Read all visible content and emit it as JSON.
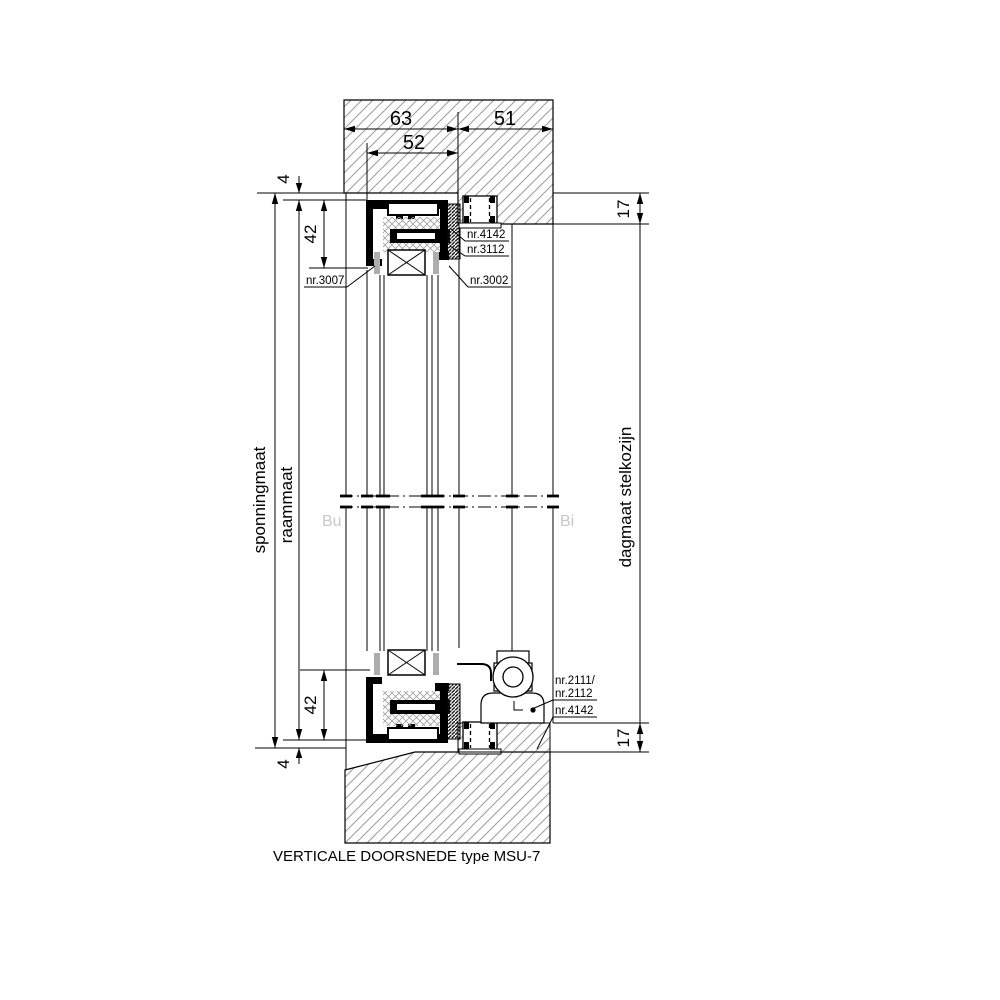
{
  "drawing": {
    "caption": "VERTICALE DOORSNEDE type  MSU-7",
    "section_markers": {
      "outside": "Bu",
      "inside": "Bi"
    },
    "dimensions": {
      "frame_depth": "63",
      "stelkozijn_depth": "51",
      "sash_depth": "52",
      "clearance_top": "4",
      "profile_height_top": "42",
      "reveal_top": "17",
      "profile_height_bottom": "42",
      "clearance_bottom": "4",
      "reveal_bottom": "17"
    },
    "axis_labels": {
      "sponningmaat": "sponningmaat",
      "raammaat": "raammaat",
      "dagmaat": "dagmaat stelkozijn"
    },
    "parts": {
      "anchor_top": "nr.4142",
      "seal_top": "nr.3112",
      "glazing_bead_outside": "nr.3007",
      "glazing_bead_inside": "nr.3002",
      "operator_line1": "nr.2111/",
      "operator_line2": "nr.2112",
      "anchor_bottom": "nr.4142"
    },
    "colors": {
      "line": "#000000",
      "hatch": "#9c9c9c",
      "marker": "#c8c8c8",
      "setting_block": "#adadad"
    }
  }
}
